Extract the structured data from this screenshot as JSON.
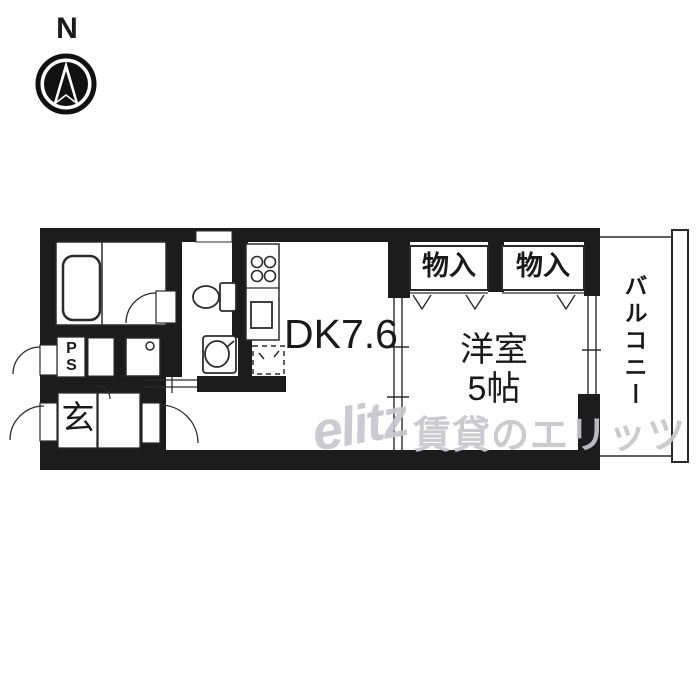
{
  "compass": {
    "north_label": "N"
  },
  "plan": {
    "dk_label": "DK7.6",
    "western_room_label": "洋室\n5帖",
    "closet_left_label": "物入",
    "closet_right_label": "物入",
    "balcony_label": "バルコニー",
    "entrance_label": "玄",
    "pipe_space_label": "P\nS"
  },
  "watermark": {
    "logo": "elitz",
    "text": "賃貸のエリッツ"
  },
  "colors": {
    "wall": "#1c1c1c",
    "line": "#2b2b2b",
    "text": "#1a1a1a",
    "watermark": "#c6c6cc"
  }
}
